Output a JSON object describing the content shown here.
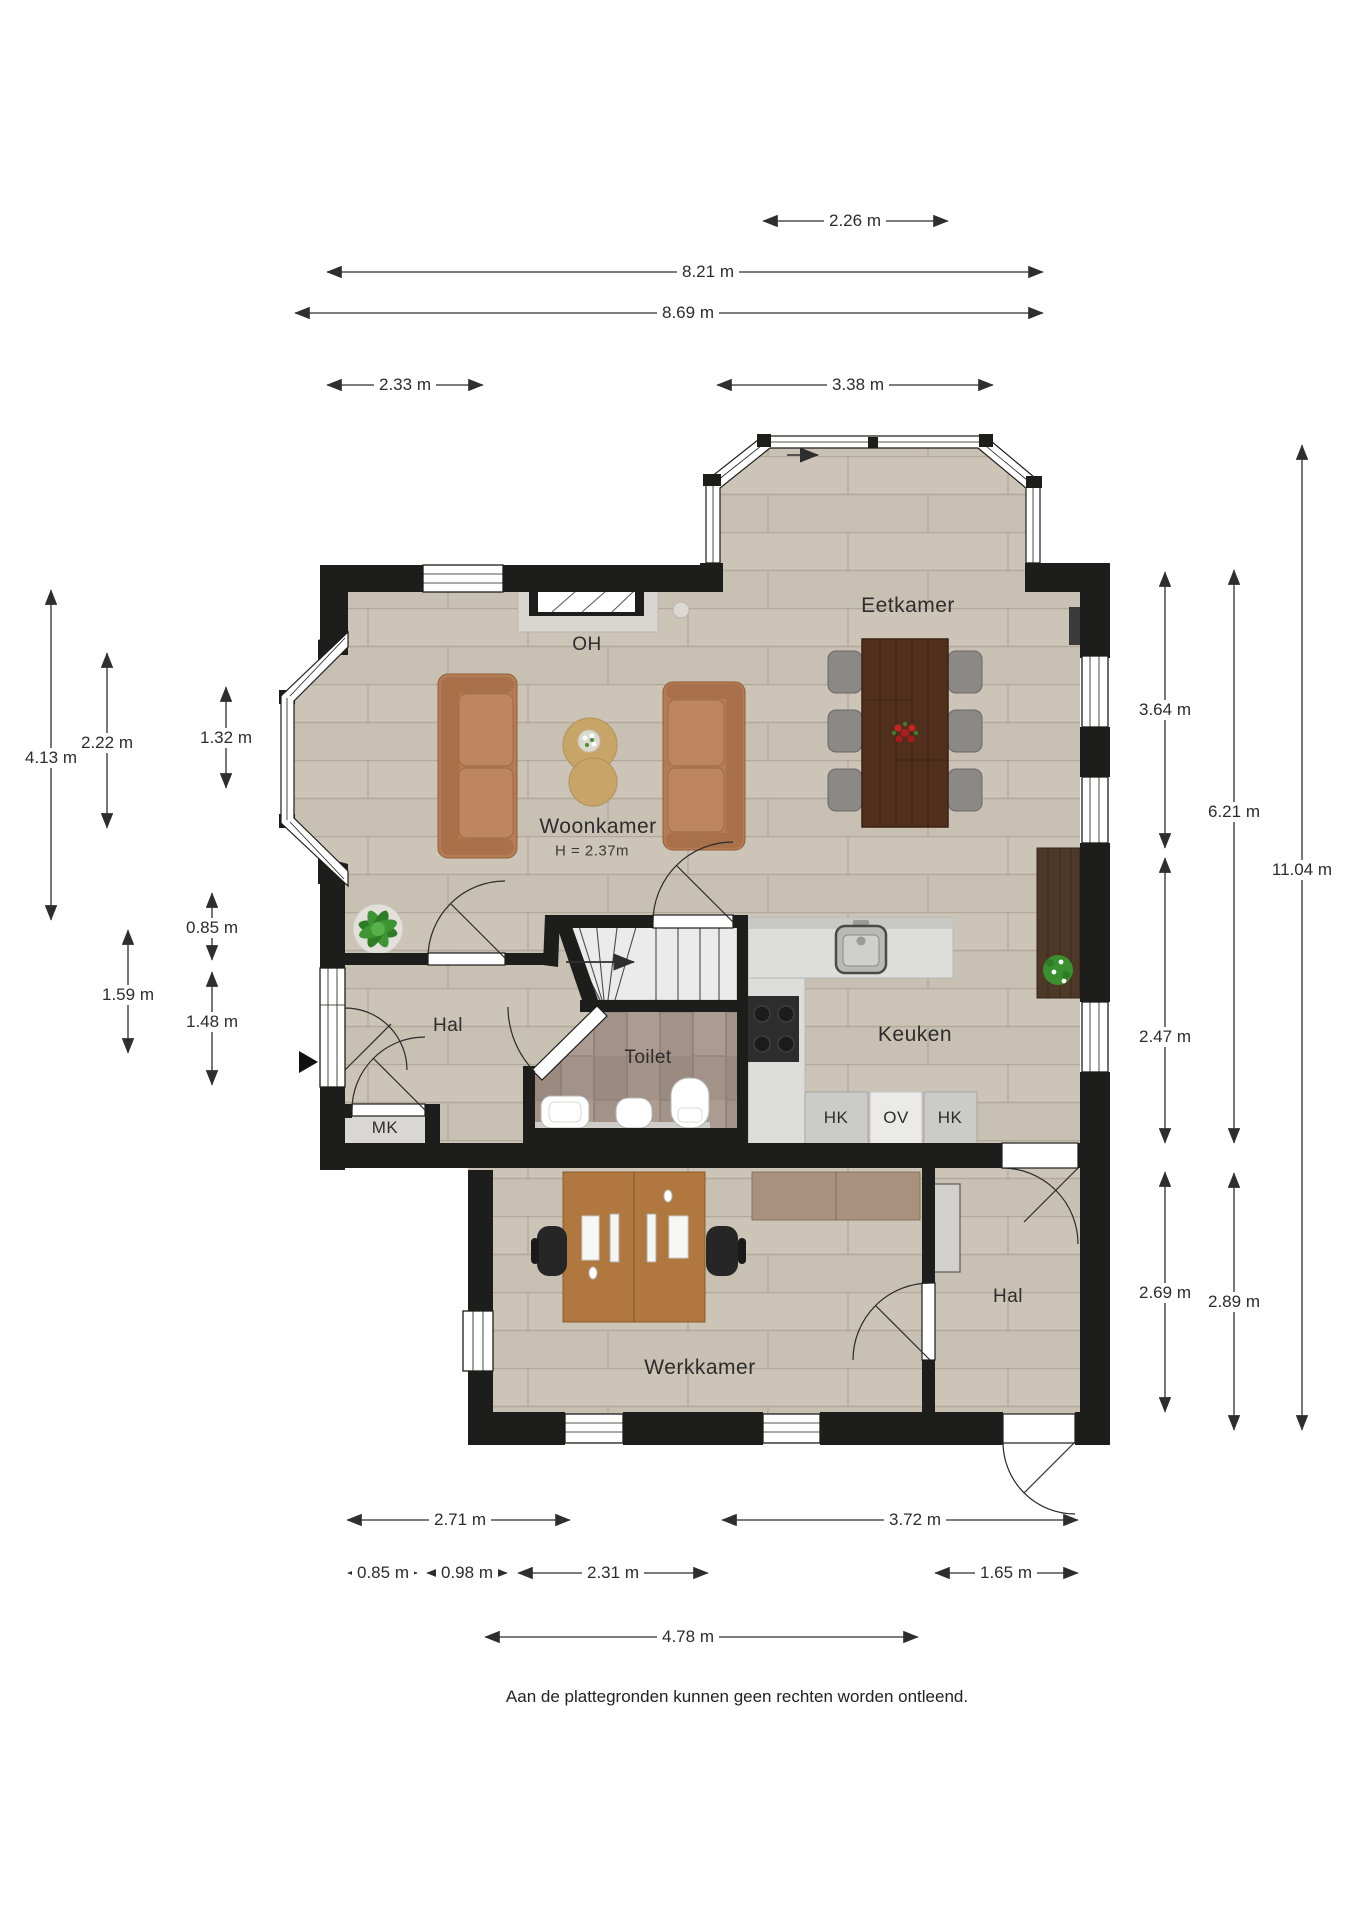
{
  "footer": {
    "disclaimer": "Aan de plattegronden kunnen geen rechten worden ontleend."
  },
  "rooms": {
    "eetkamer": {
      "label": "Eetkamer"
    },
    "fireplace": {
      "label": "OH"
    },
    "woonkamer": {
      "label": "Woonkamer",
      "height_note": "H = 2.37m"
    },
    "hal_upper": {
      "label": "Hal"
    },
    "toilet": {
      "label": "Toilet"
    },
    "keuken": {
      "label": "Keuken"
    },
    "cabinet_hk_left": {
      "label": "HK"
    },
    "cabinet_ov": {
      "label": "OV"
    },
    "cabinet_hk_right": {
      "label": "HK"
    },
    "meterkast": {
      "label": "MK"
    },
    "hal_lower": {
      "label": "Hal"
    },
    "werkkamer": {
      "label": "Werkkamer"
    }
  },
  "dimensions": {
    "top": [
      {
        "label": "2.26 m"
      },
      {
        "label": "8.21 m"
      },
      {
        "label": "8.69 m"
      },
      {
        "label": "2.33 m"
      },
      {
        "label": "3.38 m"
      }
    ],
    "bottom": [
      {
        "label": "2.71 m"
      },
      {
        "label": "3.72 m"
      },
      {
        "label": "0.85 m"
      },
      {
        "label": "0.98 m"
      },
      {
        "label": "2.31 m"
      },
      {
        "label": "1.65 m"
      },
      {
        "label": "4.78 m"
      }
    ],
    "left": [
      {
        "label": "4.13 m"
      },
      {
        "label": "2.22 m"
      },
      {
        "label": "1.32 m"
      },
      {
        "label": "0.85 m"
      },
      {
        "label": "1.59 m"
      },
      {
        "label": "1.48 m"
      }
    ],
    "right": [
      {
        "label": "3.64 m"
      },
      {
        "label": "2.47 m"
      },
      {
        "label": "2.69 m"
      },
      {
        "label": "6.21 m"
      },
      {
        "label": "2.89 m"
      },
      {
        "label": "11.04 m"
      }
    ]
  },
  "colors": {
    "wall": "#1d1d1b",
    "floor_wood": "#c8c0b3",
    "floor_tile": "#a29288",
    "sofa": "#b47c54",
    "dining_table": "#512f1d",
    "dimension_text": "#2c2c2c"
  }
}
